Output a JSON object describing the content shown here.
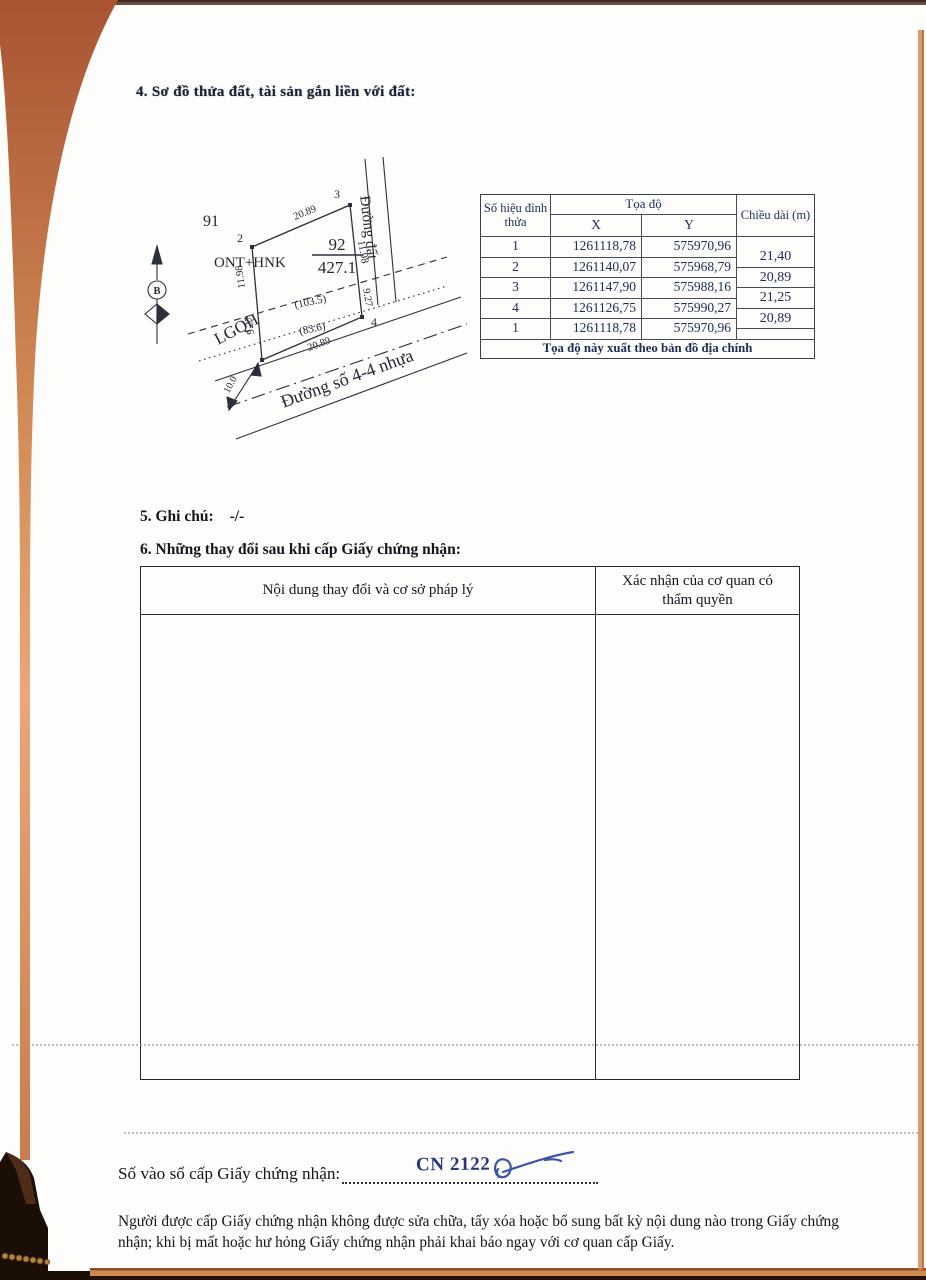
{
  "page": {
    "section4_title": "4. Sơ đồ thửa đất, tài sản gắn liền với đất:",
    "section5_label": "5. Ghi chú:",
    "section5_value": "-/-",
    "section6_title": "6. Những thay đổi sau khi cấp Giấy chứng nhận:",
    "reg_label": "Số vào sổ cấp Giấy chứng nhận:",
    "reg_number": "CN 2122",
    "footer_note": "Người được cấp Giấy chứng nhận không được sửa chữa, tẩy xóa hoặc bổ sung bất kỳ nội dung nào trong Giấy chứng nhận; khi bị mất hoặc hư hỏng Giấy chứng nhận phải khai báo ngay với cơ quan cấp Giấy."
  },
  "diagram": {
    "north_label": "B",
    "adjacent_plot": "91",
    "land_use_code": "ONT+HNK",
    "plot_number": "92",
    "plot_area": "427.1",
    "vertex_1": "1",
    "vertex_2": "2",
    "vertex_3": "3",
    "vertex_4": "4",
    "edge_top": "20.89",
    "edge_right_a": "11.98",
    "edge_right_b": "9.27",
    "edge_left_a": "11.98",
    "edge_left_b": "9.27",
    "edge_bottom": "20.89",
    "sub_area_a": "(103.5)",
    "sub_area_b": "(83.6)",
    "planning_label": "LGQH",
    "setback_width": "10.0",
    "road_right": "Đường đất",
    "road_bottom": "Đường số 4-4 nhựa"
  },
  "coord_table": {
    "header_vertex": "Số hiệu đỉnh thửa",
    "header_coords": "Tọa độ",
    "header_x": "X",
    "header_y": "Y",
    "header_length": "Chiều dài (m)",
    "rows": [
      {
        "v": "1",
        "x": "1261118,78",
        "y": "575970,96"
      },
      {
        "v": "2",
        "x": "1261140,07",
        "y": "575968,79"
      },
      {
        "v": "3",
        "x": "1261147,90",
        "y": "575988,16"
      },
      {
        "v": "4",
        "x": "1261126,75",
        "y": "575990,27"
      },
      {
        "v": "1",
        "x": "1261118,78",
        "y": "575970,96"
      }
    ],
    "lengths": [
      "21,40",
      "20,89",
      "21,25",
      "20,89"
    ],
    "footer": "Tọa độ này xuất theo bản đồ địa chính"
  },
  "changes_table": {
    "col1_header": "Nội dung thay đổi và cơ sở pháp lý",
    "col2_header": "Xác nhận của cơ quan có thẩm quyền"
  },
  "colors": {
    "ink_navy": "#202e57",
    "ink_black": "#15161d",
    "handwriting_ink": "#2a357e",
    "signature_blue": "#3d55a4",
    "scan_edge_orange": "#d08a55"
  }
}
